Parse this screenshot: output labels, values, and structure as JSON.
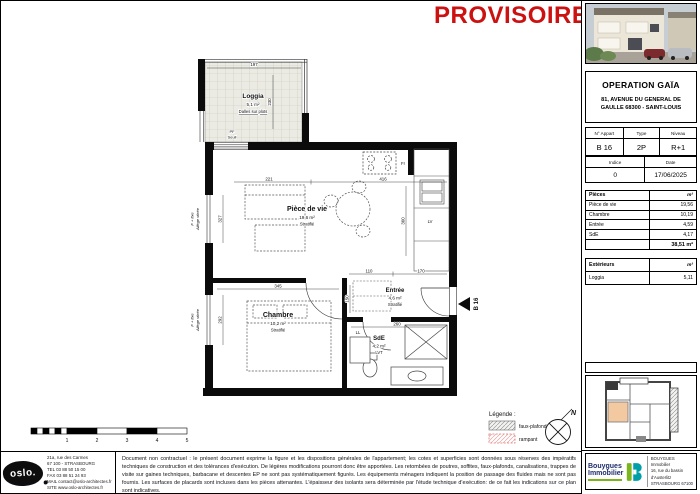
{
  "header": {
    "watermark": "PROVISOIRE"
  },
  "sidebar": {
    "project": {
      "title": "OPERATION GAÏA",
      "address1": "81, AVENUE DU GENERAL DE",
      "address2": "GAULLE 68300 - SAINT-LOUIS"
    },
    "apartment": {
      "h1": "N° Appart",
      "h2": "Type",
      "h3": "Niveau",
      "v1": "B 16",
      "v2": "2P",
      "v3": "R+1"
    },
    "meta": {
      "h1": "Indice",
      "h2": "Date",
      "v1": "0",
      "v2": "17/06/2025"
    },
    "pieces": {
      "title": "Pièces",
      "unit": "m²",
      "rows": [
        {
          "label": "Pièce de vie",
          "area": "19,56"
        },
        {
          "label": "Chambre",
          "area": "10,19"
        },
        {
          "label": "Entrée",
          "area": "4,59"
        },
        {
          "label": "SdE",
          "area": "4,17"
        }
      ],
      "total": "38,51 m²"
    },
    "exterieurs": {
      "title": "Extérieurs",
      "unit": "m²",
      "rows": [
        {
          "label": "Loggia",
          "area": "5,11"
        }
      ]
    },
    "publisher": {
      "brand1": "Bouygues",
      "brand2": "Immobilier",
      "address1": "BOUYGUES Immobilier",
      "address2": "16, rue du bassin d'Austerlitz",
      "address3": "STRASBOURG 67100"
    }
  },
  "plan": {
    "rooms": {
      "loggia": {
        "name": "Loggia",
        "area": "5,1 m²",
        "finish": "Dalles sur plots"
      },
      "living": {
        "name": "Pièce de vie",
        "area": "19,6 m²",
        "finish": "Stratifié"
      },
      "chambre": {
        "name": "Chambre",
        "area": "10,2 m²",
        "finish": "Stratifié"
      },
      "entree": {
        "name": "Entrée",
        "area": "4,6 m²",
        "finish": "Stratifié"
      },
      "sde": {
        "name": "SdE",
        "area": "4,2 m²",
        "finish": "LVT"
      }
    },
    "labels": {
      "pf": "PF",
      "seuil": "Seuil",
      "fr": "Fr",
      "lv": "LV",
      "ll": "LL",
      "unit_marker": "B 16",
      "window": "F + fixe",
      "window_sub": "Allège vitrée",
      "north": "N"
    },
    "dims": {
      "loggia_w": "197",
      "loggia_h": "230",
      "living_a": "221",
      "living_b": "416",
      "win_top": "327",
      "win_bottom": "292",
      "chambre_w": "345",
      "entree_a": "110",
      "entree_b": "170",
      "entree_h": "150",
      "sde_w": "260",
      "kitchen_h": "360"
    }
  },
  "legend": {
    "title": "Légende :",
    "item1": "faux-plafond",
    "item2": "rampant"
  },
  "scalebar": {
    "t1": "1",
    "t2": "2",
    "t3": "3",
    "t4": "4",
    "t5": "5"
  },
  "footer": {
    "architect": {
      "logo": "oslo.",
      "line1": "21a, rue des Carmes",
      "line2": "67 100 - STRASBOURG",
      "line3": "TEL 03 88 50 15 00",
      "line4": "FAX 03 88 51 24 93",
      "line5": "MAIL contact@oslo-architectes.fr",
      "line6": "SITE www.oslo-architectes.fr"
    },
    "disclaimer": "Document non contractuel : le présent document exprime la figure et les dispositions générales de l'appartement; les cotes et superficies sont données sous réserves des impératifs techniques de construction et des tolérances d'exécution. De légères modifications pourront donc être apportées. Les retombées de poutres, soffites, faux-plafonds, canalisations, trappes de visite sur gaines techniques, barbacane et descentes EP ne sont pas systématiquement figurés. Les équipements ménagers indiquent la position de passage des fluides mais ne sont pas fournis. Les surfaces de placards sont incluses dans les pièces attenantes. L'épaisseur des isolants sera déterminée par l'étude technique d'exécution: de ce fait les indications sur ce plan sont indicatives."
  }
}
